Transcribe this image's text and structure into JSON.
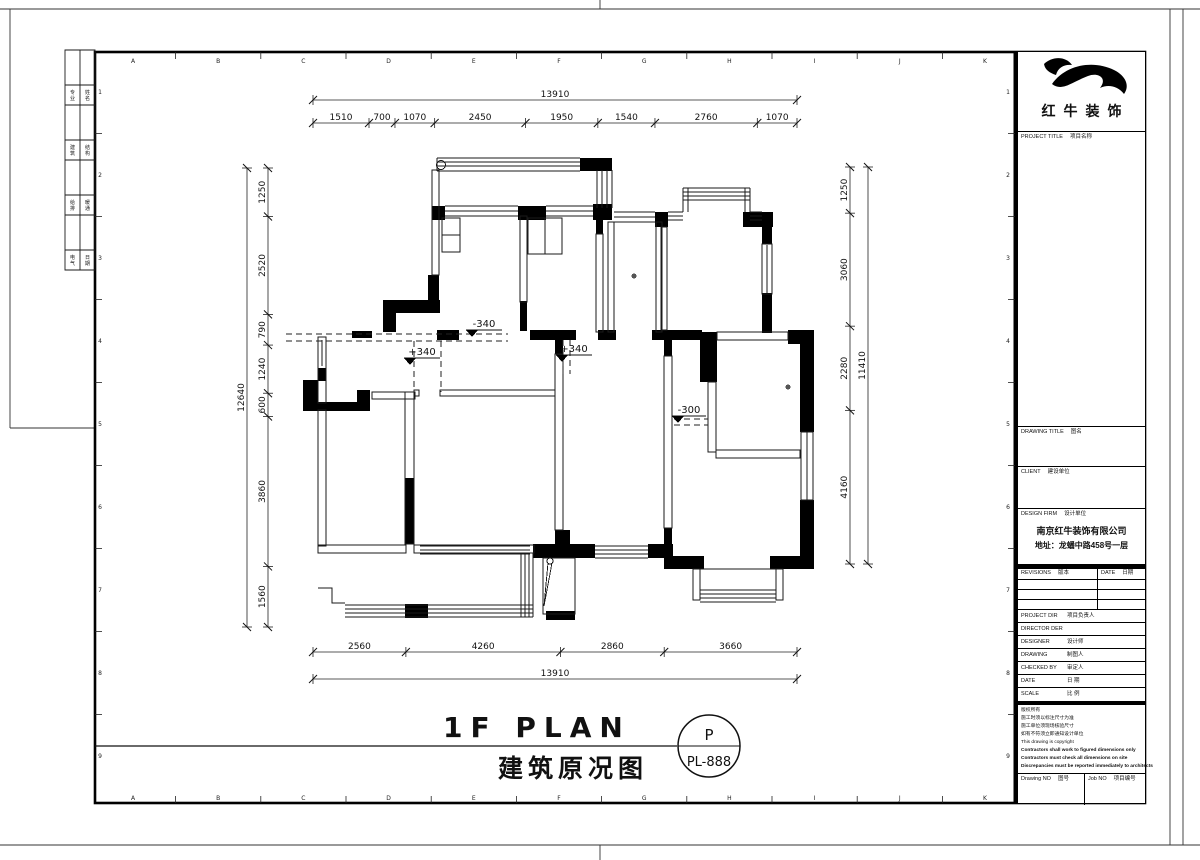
{
  "sheet": {
    "grid_letters": [
      "A",
      "B",
      "C",
      "D",
      "E",
      "F",
      "G",
      "H",
      "I",
      "J",
      "K"
    ],
    "grid_numbers": [
      "1",
      "2",
      "3",
      "4",
      "5",
      "6",
      "7",
      "8",
      "9"
    ],
    "sign_strip": [
      "专业",
      "姓名",
      "建筑",
      "结构",
      "给排",
      "暖通",
      "电气",
      "日期"
    ]
  },
  "plan": {
    "dims_top_total": [
      "13910"
    ],
    "dims_top": [
      "1510",
      "700",
      "1070",
      "2450",
      "1950",
      "1540",
      "2760",
      "1070"
    ],
    "dims_bottom": [
      "2560",
      "4260",
      "2860",
      "3660"
    ],
    "dims_bottom_total": [
      "13910"
    ],
    "dims_left_total": [
      "12640"
    ],
    "dims_left": [
      "1250",
      "2520",
      "790",
      "1240",
      "600",
      "3860",
      "1560"
    ],
    "dims_right": [
      "1250",
      "3060",
      "2280",
      "4160"
    ],
    "dims_right_total": [
      "11410"
    ],
    "levels": [
      "-340",
      "+340",
      "+340",
      "-300"
    ]
  },
  "caption": {
    "title_en": "1F PLAN",
    "title_zh": "建筑原况图",
    "stamp_top": "P",
    "stamp_bottom": "PL-888"
  },
  "titleblock": {
    "brand": "红牛装饰",
    "project_title": {
      "en": "PROJECT TITLE",
      "zh": "项目名称"
    },
    "drawing_title": {
      "en": "DRAWING TITLE",
      "zh": "图名"
    },
    "client": {
      "en": "CLIENT",
      "zh": "建设单位"
    },
    "design_firm": {
      "en": "DESIGN FIRM",
      "zh": "设计单位"
    },
    "firm_name": "南京红牛装饰有限公司",
    "firm_addr": "地址：龙蟠中路458号一层",
    "revisions": {
      "en": "REVISIONS",
      "zh": "版本"
    },
    "rev_date": {
      "en": "DATE",
      "zh": "日期"
    },
    "staff_rows": [
      {
        "en": "PROJECT DIR",
        "zh": "项目负责人"
      },
      {
        "en": "DIRECTOR DER",
        "zh": ""
      },
      {
        "en": "DESIGNER",
        "zh": "设计师"
      },
      {
        "en": "DRAWING",
        "zh": "制图人"
      },
      {
        "en": "CHECKED BY",
        "zh": "审定人"
      },
      {
        "en": "DATE",
        "zh": "日 期"
      },
      {
        "en": "SCALE",
        "zh": "比 例"
      }
    ],
    "copyright": [
      "版权所有",
      "施工时须以标注尺寸为准",
      "施工单位须现场核验尺寸",
      "如有不符须立即通知设计单位",
      "This drawing is copyright",
      "Contractors shall work to figured dimensions only",
      "Contractors must check all dimensions on site",
      "Discrepancies must be reported immediately to architects"
    ],
    "drawing_no": {
      "en": "Drawing NO",
      "zh": "图号"
    },
    "job_no": {
      "en": "Job NO",
      "zh": "项目编号"
    }
  }
}
